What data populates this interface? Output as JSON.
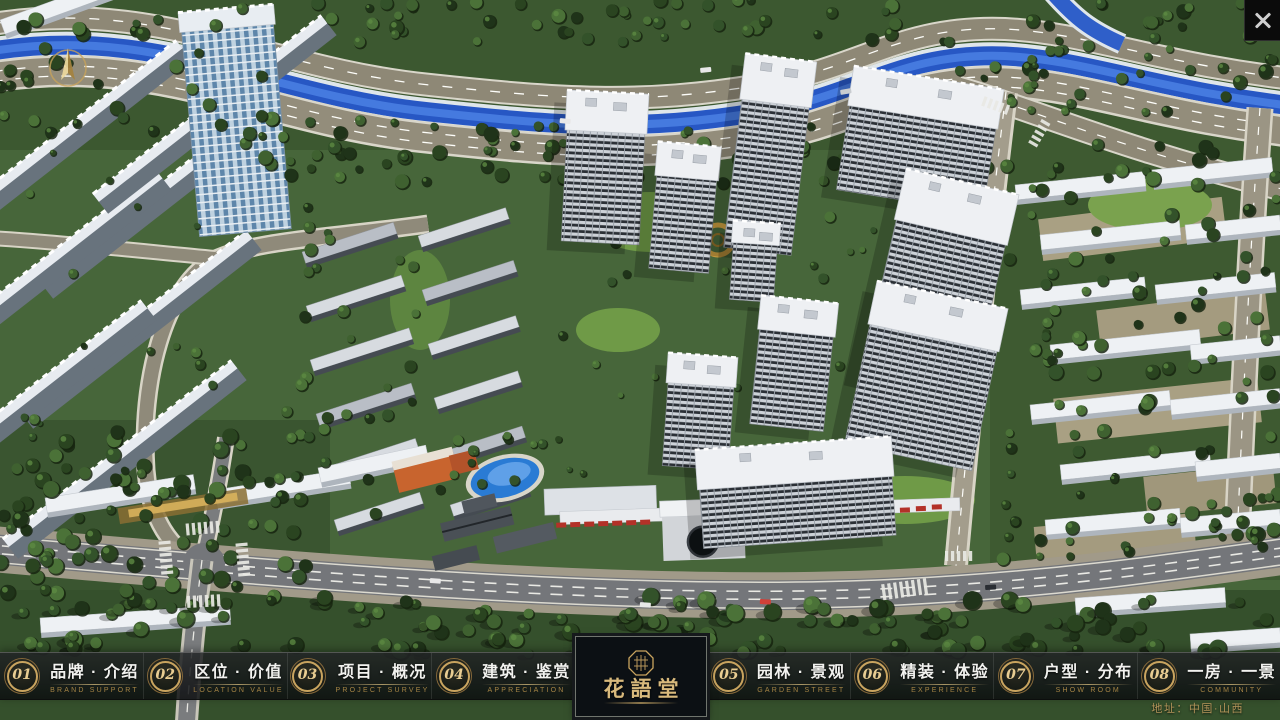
{
  "window": {
    "close_label": "✕"
  },
  "navbar": {
    "items": [
      {
        "num": "01",
        "title": "品牌 · 介绍",
        "caption": "BRAND SUPPORT"
      },
      {
        "num": "02",
        "title": "区位 · 价值",
        "caption": "LOCATION VALUE"
      },
      {
        "num": "03",
        "title": "项目 · 概况",
        "caption": "PROJECT SURVEY"
      },
      {
        "num": "04",
        "title": "建筑 · 鉴赏",
        "caption": "APPRECIATION"
      },
      {
        "num": "05",
        "title": "园林 · 景观",
        "caption": "GARDEN STREET"
      },
      {
        "num": "06",
        "title": "精装 · 体验",
        "caption": "EXPERIENCE"
      },
      {
        "num": "07",
        "title": "户型 · 分布",
        "caption": "SHOW ROOM"
      },
      {
        "num": "08",
        "title": "一房 · 一景",
        "caption": "COMMUNITY"
      }
    ]
  },
  "logo": {
    "title": "花語堂"
  },
  "footer": {
    "address": "地址：中国·山西"
  },
  "colors": {
    "gold": "#c9a45f",
    "bar_bg": "rgba(16,18,20,0.85)",
    "river": "#2757c4",
    "road_tan": "#938d7b",
    "asphalt": "#74767a",
    "tree_dark": "#24371f",
    "building_white": "#eef0f3"
  }
}
